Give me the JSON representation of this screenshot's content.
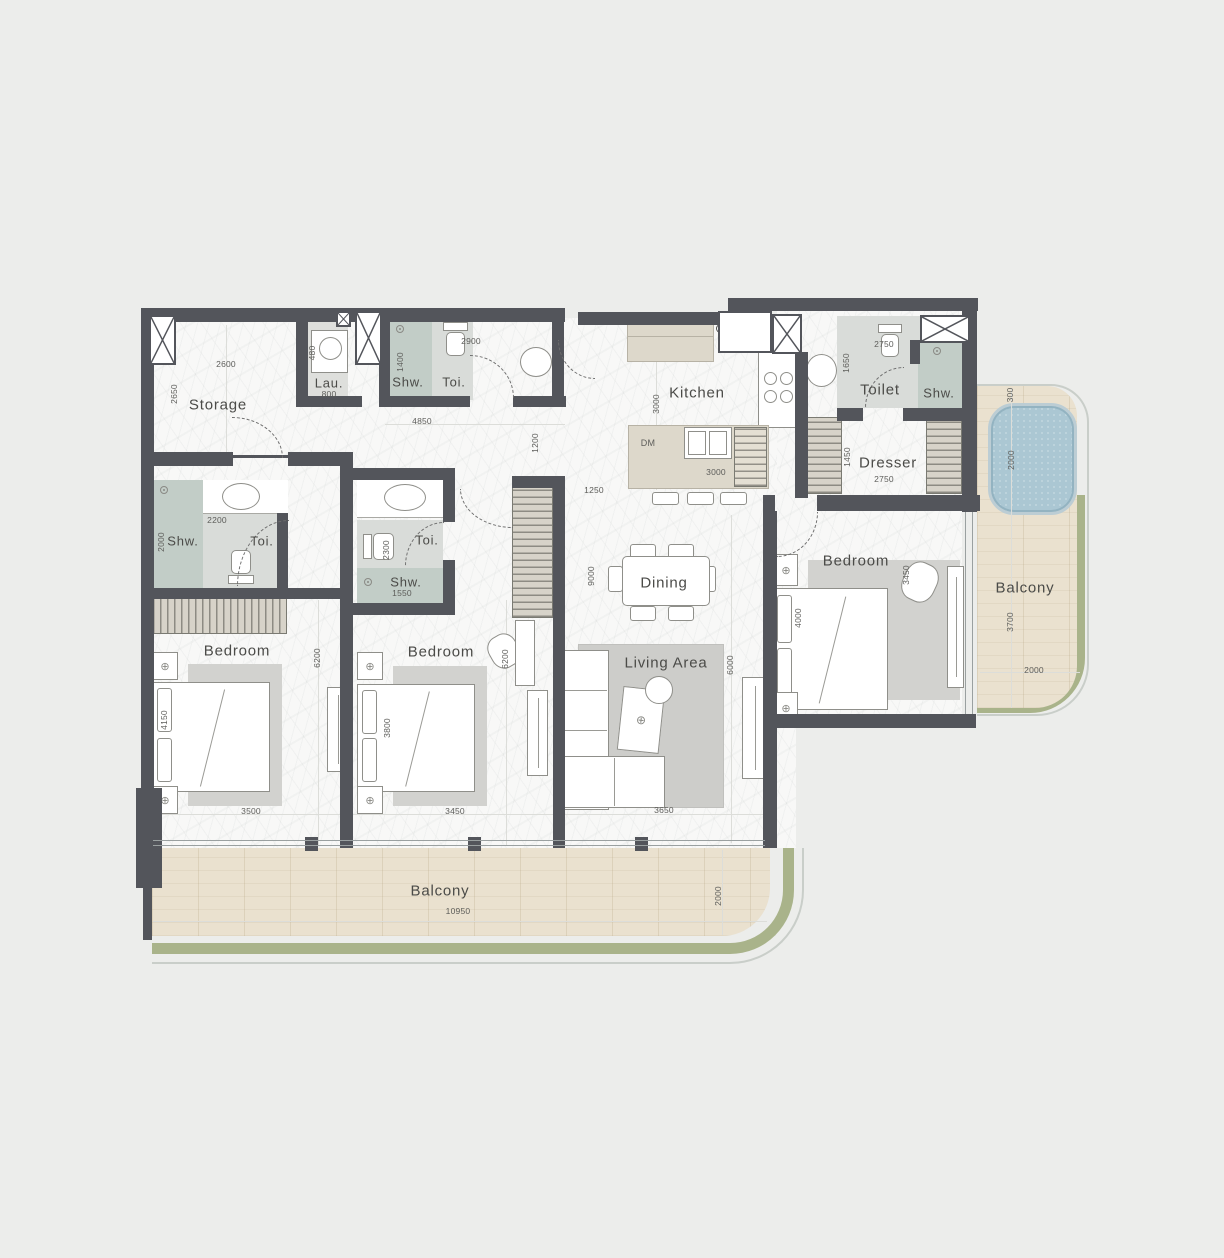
{
  "colors": {
    "wall": "#53555b",
    "bath": "#d9dcd9",
    "shower": "#c2cdc7",
    "wood": "#eae1cf",
    "green": "#a9b38a",
    "pool": "#abc7d3",
    "beige": "#ddd8cb",
    "hatchbg": "#d7d3c9",
    "dim": "#5d5d5a",
    "label": "#4b4b48",
    "line": "#9aa0a0"
  },
  "rooms": {
    "storage": {
      "label": "Storage",
      "dim_w": "2600",
      "dim_h": "2650"
    },
    "laundry": {
      "label": "Lau.",
      "dim_under": "800",
      "dim_side": "480"
    },
    "bath_top": {
      "shw": "Shw.",
      "toi": "Toi.",
      "dim_w": "2900",
      "dim_h": "1400"
    },
    "foyer": {
      "dim_w": "4850",
      "dim_h": "1200"
    },
    "kitchen": {
      "label": "Kitchen",
      "dim_depth": "3000",
      "island_dim": "3000",
      "entry_dim": "1250",
      "dishwasher": "DM"
    },
    "toilet": {
      "label": "Toilet",
      "shw": "Shw.",
      "dim_w": "2750",
      "dim_h": "1650"
    },
    "dresser": {
      "label": "Dresser",
      "dim_w": "2750",
      "dim_h": "1450"
    },
    "bath_left": {
      "shw": "Shw.",
      "toi": "Toi.",
      "dim_w": "2200",
      "dim_h": "2000"
    },
    "bath_mid": {
      "shw": "Shw.",
      "toi": "Toi.",
      "dim_w": "1550",
      "dim_h": "2300"
    },
    "hall": {
      "dim_depth": "9000"
    },
    "dining": {
      "label": "Dining"
    },
    "living": {
      "label": "Living Area",
      "dim_w": "3650",
      "dim_h": "6000"
    },
    "bedroom1": {
      "label": "Bedroom",
      "bed_dim": "4150",
      "dim_w": "3500",
      "dim_h": "6200"
    },
    "bedroom2": {
      "label": "Bedroom",
      "bed_dim": "3800",
      "dim_w": "3450",
      "dim_h": "6200"
    },
    "bedroom3": {
      "label": "Bedroom",
      "bed_dim": "4000",
      "dim_side": "3450"
    },
    "balcony_bottom": {
      "label": "Balcony",
      "dim_w": "10950",
      "dim_h": "2000"
    },
    "balcony_right": {
      "label": "Balcony",
      "gap_dim": "300",
      "pool_dim": "2000",
      "dim_h": "3700",
      "dim_w": "2000"
    }
  }
}
